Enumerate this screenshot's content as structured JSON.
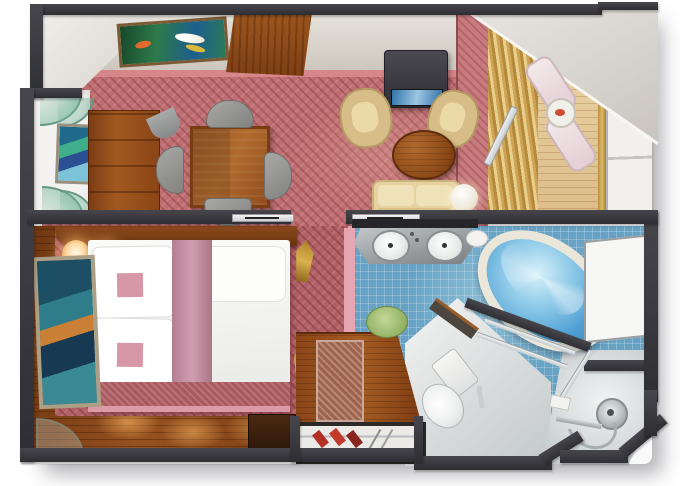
{
  "meta": {
    "title": "suite-floor-plan-render",
    "canvas_width": 680,
    "canvas_height": 486
  },
  "palette": {
    "wall": "#3a3a3f",
    "carpet_living": "#bd6e72",
    "carpet_bedroom": "#b06067",
    "wood_floor": "#7c3f16",
    "wood_furniture": "#9a5524",
    "balcony_wood": "#e2c896",
    "tile_blue": "#67a2c4",
    "jacuzzi_water": "#4f9fd3",
    "curtain_gold": "#cfa356",
    "pink_trim": "#dd9ba9",
    "upholstery_beige": "#e6d2a0",
    "fixture_white": "#f4f5f4",
    "glass_frosted": "#f1f0ed",
    "shelf_glass_teal": "#7db4a0",
    "accent_shoes_red": "#b23026",
    "mat_green": "#93b264"
  },
  "rooms": [
    {
      "id": "entry",
      "label": "entry-hall"
    },
    {
      "id": "living",
      "label": "living-dining-room"
    },
    {
      "id": "balcony",
      "label": "private-balcony"
    },
    {
      "id": "bedroom",
      "label": "bedroom"
    },
    {
      "id": "wardrobe",
      "label": "wardrobe-closet"
    },
    {
      "id": "bathroom",
      "label": "bathroom"
    },
    {
      "id": "toilet",
      "label": "toilet-nook"
    },
    {
      "id": "shower",
      "label": "shower-room"
    }
  ],
  "furniture": [
    "koi-pond-artwork",
    "entry-door-panel",
    "glass-display-shelves",
    "niche-painting",
    "dresser",
    "dining-table",
    "dining-chairs-x4",
    "tv-cabinet",
    "armchairs-x2",
    "round-coffee-table",
    "sofa",
    "table-lamp",
    "gold-curtains",
    "lounge-chairs-x2",
    "balcony-table",
    "glass-balustrade",
    "bed-queen",
    "pillows-with-pink-cushions",
    "mauve-bed-runner",
    "bedside-lamps-x2",
    "wall-painting",
    "dried-gold-plants",
    "wardrobe-counter",
    "wardrobe-shoes",
    "double-sink-vanity",
    "oval-jacuzzi-tub",
    "green-bath-mat",
    "toilet",
    "frosted-window",
    "hand-shower",
    "glass-shower-door"
  ]
}
